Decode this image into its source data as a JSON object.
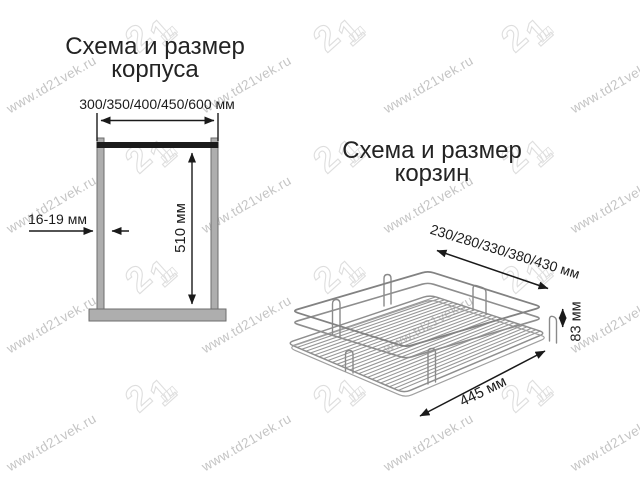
{
  "watermark": {
    "text": "www.td21vek.ru",
    "logo_text": "21",
    "text_color": "#c5c5c5",
    "logo_color": "#dedede"
  },
  "colors": {
    "ink": "#232323",
    "line": "#1a1a1a",
    "wall_fill": "#aeaeae",
    "wall_stroke": "#6e6e6e",
    "wire": "#8e8e8e"
  },
  "cabinet_diagram": {
    "title_line1": "Схема и размер",
    "title_line2": "корпуса",
    "width_label": "300/350/400/450/600 мм",
    "height_label": "510 мм",
    "thickness_label": "16-19 мм"
  },
  "basket_diagram": {
    "title_line1": "Схема и размер",
    "title_line2": "корзин",
    "width_label": "230/280/330/380/430 мм",
    "height_label": "83 мм",
    "depth_label": "445 мм"
  }
}
